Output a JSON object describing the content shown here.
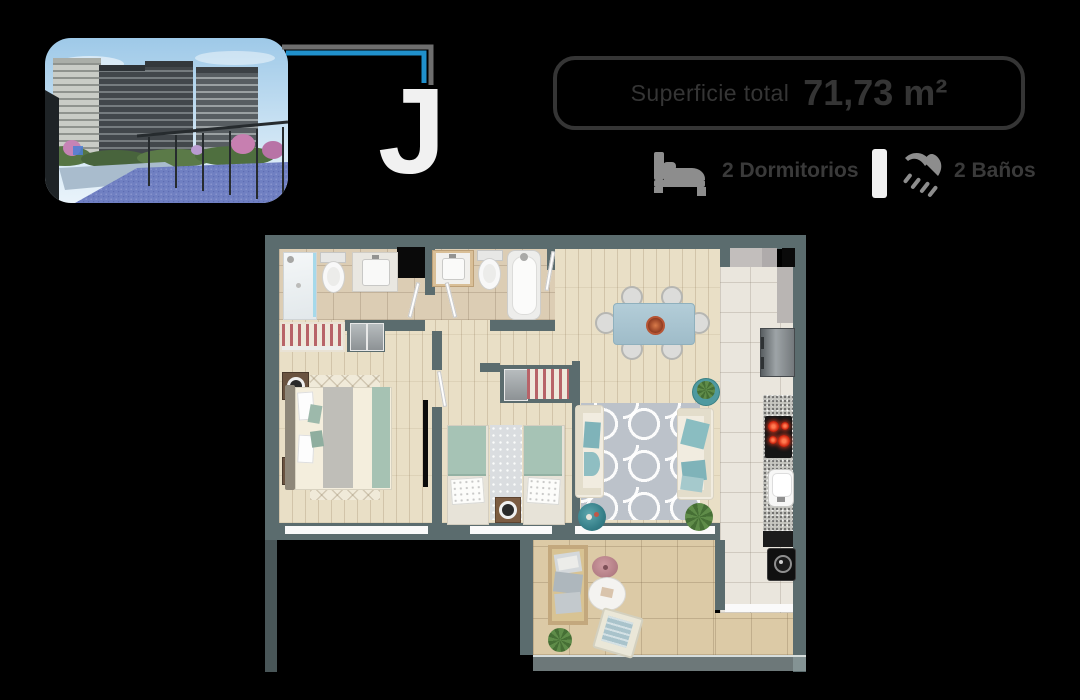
{
  "page": {
    "background_color": "#000000"
  },
  "hero": {
    "photo_name": "project-exterior-render",
    "photo_description": "Render of residential towers with gardens, pink flowering trees and a blue paddle court",
    "connector_colors": {
      "blue": "#2090cc",
      "gray": "#6e6e6e"
    },
    "unit_model": "J"
  },
  "surface_badge": {
    "label": "Superficie total",
    "value": "71,73 m²",
    "text_color": "#353535"
  },
  "stats": {
    "bedrooms": {
      "icon": "bed-icon",
      "label": "2 Dormitorios"
    },
    "bathrooms": {
      "icon": "shower-icon",
      "label": "2 Baños"
    },
    "divider_color": "#f1f1f1",
    "icon_color": "#8d8d8d",
    "text_color": "#3a3a3a"
  },
  "floor_plan": {
    "wall_color": "#5b6c6e",
    "floor_wood_color": "#e9dfc6",
    "bath_tile_color": "#dccdb4",
    "kitchen_tile_color": "#eae6dd",
    "terrace_tile_color": "#dccaa6",
    "rooms": [
      "bathroom-1",
      "bathroom-2",
      "main-bedroom",
      "second-bedroom",
      "hall",
      "living-dining",
      "kitchen",
      "laundry-loggia",
      "terrace"
    ]
  }
}
